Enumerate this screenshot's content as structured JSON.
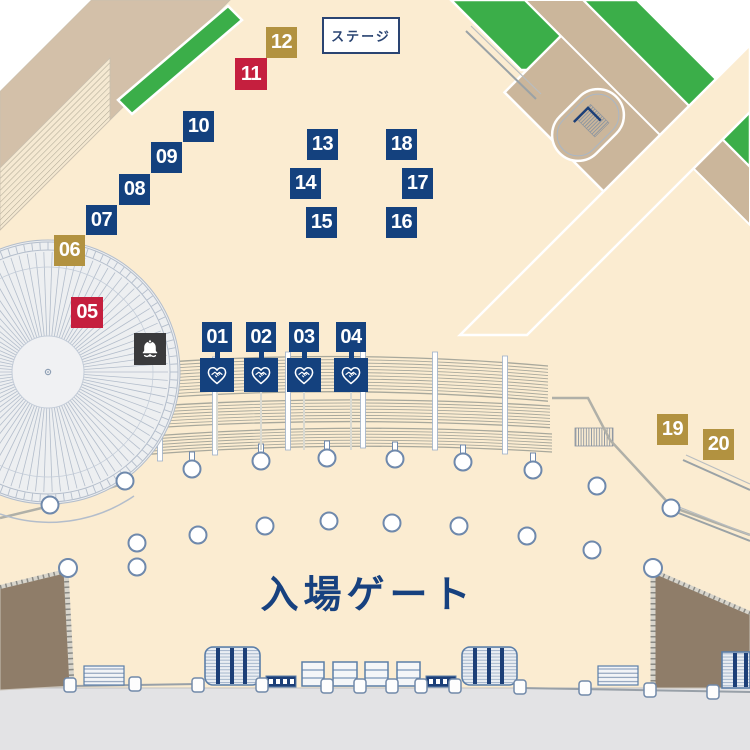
{
  "map": {
    "title": "event-venue-floor-map",
    "stage": {
      "label": "ステージ",
      "x": 322,
      "y": 17,
      "w": 78,
      "h": 37
    },
    "entrance": {
      "label": "入場ゲート",
      "x": 368,
      "y": 591
    },
    "colors": {
      "booth_blue": "#14417E",
      "booth_red": "#C51F3E",
      "booth_gold": "#B29240",
      "bell_dark": "#3A3A3C",
      "ground_beige": "#FBECD1",
      "lawn_green": "#3BAE49",
      "path_tan": "#D3C0A9",
      "building_tan": "#CBB69B",
      "stand_brown": "#8F7D69",
      "outside_gray": "#E3E3E5",
      "text_navy": "#17417F"
    },
    "booths": [
      {
        "label": "01",
        "type": "blue",
        "x": 202,
        "y": 322,
        "w": 30,
        "h": 30,
        "handshake": true
      },
      {
        "label": "02",
        "type": "blue",
        "x": 246,
        "y": 322,
        "w": 30,
        "h": 30,
        "handshake": true
      },
      {
        "label": "03",
        "type": "blue",
        "x": 289,
        "y": 322,
        "w": 30,
        "h": 30,
        "handshake": true
      },
      {
        "label": "04",
        "type": "blue",
        "x": 336,
        "y": 322,
        "w": 30,
        "h": 30,
        "handshake": true
      },
      {
        "label": "05",
        "type": "red",
        "x": 71,
        "y": 297,
        "w": 32,
        "h": 31
      },
      {
        "label": "06",
        "type": "gold",
        "x": 54,
        "y": 235,
        "w": 31,
        "h": 31
      },
      {
        "label": "07",
        "type": "blue",
        "x": 86,
        "y": 205,
        "w": 31,
        "h": 30
      },
      {
        "label": "08",
        "type": "blue",
        "x": 119,
        "y": 174,
        "w": 31,
        "h": 31
      },
      {
        "label": "09",
        "type": "blue",
        "x": 151,
        "y": 142,
        "w": 31,
        "h": 31
      },
      {
        "label": "10",
        "type": "blue",
        "x": 183,
        "y": 111,
        "w": 31,
        "h": 31
      },
      {
        "label": "11",
        "type": "red",
        "x": 235,
        "y": 58,
        "w": 32,
        "h": 32
      },
      {
        "label": "12",
        "type": "gold",
        "x": 266,
        "y": 27,
        "w": 31,
        "h": 31
      },
      {
        "label": "13",
        "type": "blue",
        "x": 307,
        "y": 129,
        "w": 31,
        "h": 31
      },
      {
        "label": "14",
        "type": "blue",
        "x": 290,
        "y": 168,
        "w": 31,
        "h": 31
      },
      {
        "label": "15",
        "type": "blue",
        "x": 306,
        "y": 207,
        "w": 31,
        "h": 31
      },
      {
        "label": "16",
        "type": "blue",
        "x": 386,
        "y": 207,
        "w": 31,
        "h": 31
      },
      {
        "label": "17",
        "type": "blue",
        "x": 402,
        "y": 168,
        "w": 31,
        "h": 31
      },
      {
        "label": "18",
        "type": "blue",
        "x": 386,
        "y": 129,
        "w": 31,
        "h": 31
      },
      {
        "label": "19",
        "type": "gold",
        "x": 657,
        "y": 414,
        "w": 31,
        "h": 31
      },
      {
        "label": "20",
        "type": "gold",
        "x": 703,
        "y": 429,
        "w": 31,
        "h": 31
      }
    ],
    "bell_marker": {
      "x": 134,
      "y": 333,
      "w": 32,
      "h": 32,
      "icon": "bell-icon"
    },
    "handshake_icon_meaning": "handshake-in-heart-icon"
  }
}
